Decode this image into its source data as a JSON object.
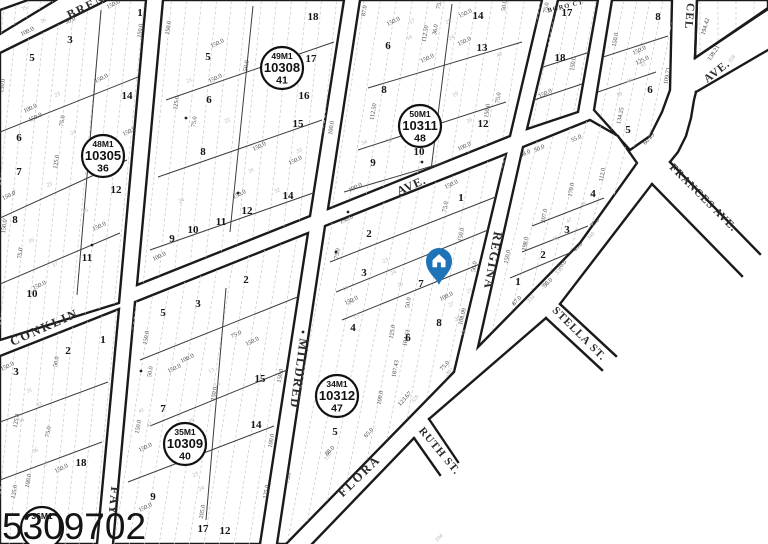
{
  "watermark": "5309702",
  "pin": {
    "color": "#1d72b8"
  },
  "streets": [
    {
      "name": "BREN",
      "x": 88,
      "y": 10,
      "rot": -26,
      "size": 12,
      "ls": 2,
      "faint": false
    },
    {
      "name": "CONKLIN",
      "x": 46,
      "y": 331,
      "rot": -24,
      "size": 12.5,
      "ls": 2,
      "faint": false
    },
    {
      "name": "AVE.",
      "x": 413,
      "y": 189,
      "rot": -24,
      "size": 12,
      "ls": 1,
      "faint": false
    },
    {
      "name": "FAY",
      "x": 110,
      "y": 501,
      "rot": 95,
      "size": 12.5,
      "ls": 2,
      "faint": false
    },
    {
      "name": "MILDRED",
      "x": 295,
      "y": 373,
      "rot": 98,
      "size": 12.5,
      "ls": 1.5,
      "faint": false
    },
    {
      "name": "REGINA",
      "x": 489,
      "y": 260,
      "rot": 100,
      "size": 12.5,
      "ls": 1.5,
      "faint": false
    },
    {
      "name": "FLORA",
      "x": 362,
      "y": 479,
      "rot": -44,
      "size": 12.5,
      "ls": 2,
      "faint": false
    },
    {
      "name": "RUTH ST.",
      "x": 437,
      "y": 453,
      "rot": 50,
      "size": 11,
      "ls": 1,
      "faint": false
    },
    {
      "name": "STELLA ST.",
      "x": 577,
      "y": 336,
      "rot": 45,
      "size": 11,
      "ls": 1,
      "faint": false
    },
    {
      "name": "FRANCES AVE.",
      "x": 701,
      "y": 200,
      "rot": 45,
      "size": 11,
      "ls": 1,
      "faint": false
    },
    {
      "name": "CEL",
      "x": 686,
      "y": 16,
      "rot": 95,
      "size": 11.5,
      "ls": 1,
      "faint": false
    },
    {
      "name": "AVE.",
      "x": 719,
      "y": 74,
      "rot": -38,
      "size": 11.5,
      "ls": 1,
      "faint": false
    },
    {
      "name": "BORO CT",
      "x": 566,
      "y": 8,
      "rot": -14,
      "size": 6.5,
      "ls": 1,
      "faint": true
    }
  ],
  "markers": [
    {
      "line1": "48M1",
      "line2": "10305",
      "line3": "36",
      "x": 103,
      "y": 156
    },
    {
      "line1": "49M1",
      "line2": "10308",
      "line3": "41",
      "x": 282,
      "y": 68
    },
    {
      "line1": "50M1",
      "line2": "10311",
      "line3": "48",
      "x": 420,
      "y": 126
    },
    {
      "line1": "34M1",
      "line2": "10312",
      "line3": "47",
      "x": 337,
      "y": 396
    },
    {
      "line1": "35M1",
      "line2": "10309",
      "line3": "40",
      "x": 185,
      "y": 444
    },
    {
      "line1": "36M1",
      "line2": "",
      "line3": "",
      "x": 42,
      "y": 528
    }
  ],
  "lots": [
    [
      "1",
      140,
      16
    ],
    [
      "3",
      70,
      43
    ],
    [
      "5",
      32,
      61
    ],
    [
      "14",
      127,
      99
    ],
    [
      "6",
      19,
      141
    ],
    [
      "7",
      19,
      175
    ],
    [
      "12",
      116,
      193
    ],
    [
      "8",
      15,
      223
    ],
    [
      "11",
      87,
      261
    ],
    [
      "10",
      32,
      297
    ],
    [
      "18",
      313,
      20
    ],
    [
      "17",
      311,
      62
    ],
    [
      "16",
      304,
      99
    ],
    [
      "15",
      298,
      127
    ],
    [
      "5",
      208,
      60
    ],
    [
      "6",
      209,
      103
    ],
    [
      "8",
      203,
      155
    ],
    [
      "14",
      288,
      199
    ],
    [
      "12",
      247,
      214
    ],
    [
      "11",
      221,
      225
    ],
    [
      "10",
      193,
      233
    ],
    [
      "9",
      172,
      242
    ],
    [
      "6",
      388,
      49
    ],
    [
      "8",
      384,
      93
    ],
    [
      "14",
      478,
      19
    ],
    [
      "13",
      482,
      51
    ],
    [
      "12",
      483,
      127
    ],
    [
      "10",
      419,
      155
    ],
    [
      "9",
      373,
      166
    ],
    [
      "17",
      567,
      16
    ],
    [
      "18",
      560,
      61
    ],
    [
      "8",
      658,
      20
    ],
    [
      "6",
      650,
      93
    ],
    [
      "5",
      628,
      133
    ],
    [
      "4",
      593,
      197
    ],
    [
      "3",
      567,
      233
    ],
    [
      "2",
      543,
      258
    ],
    [
      "1",
      518,
      285
    ],
    [
      "1",
      461,
      201
    ],
    [
      "2",
      369,
      237
    ],
    [
      "3",
      364,
      276
    ],
    [
      "7",
      421,
      287
    ],
    [
      "8",
      439,
      326
    ],
    [
      "6",
      408,
      341
    ],
    [
      "4",
      353,
      331
    ],
    [
      "5",
      335,
      435
    ],
    [
      "2",
      246,
      283
    ],
    [
      "3",
      198,
      307
    ],
    [
      "5",
      163,
      316
    ],
    [
      "15",
      260,
      382
    ],
    [
      "7",
      163,
      412
    ],
    [
      "14",
      256,
      428
    ],
    [
      "9",
      153,
      500
    ],
    [
      "17",
      203,
      532
    ],
    [
      "12",
      225,
      534
    ],
    [
      "1",
      103,
      343
    ],
    [
      "2",
      68,
      354
    ],
    [
      "3",
      16,
      375
    ],
    [
      "18",
      81,
      466
    ]
  ],
  "dims": [
    [
      "150.0",
      114,
      6,
      -26
    ],
    [
      "50.0",
      71,
      22,
      -26
    ],
    [
      "100.0",
      28,
      33,
      -26
    ],
    [
      "150.0",
      142,
      31,
      -82
    ],
    [
      "150.0",
      4,
      86,
      -82
    ],
    [
      "150.0",
      102,
      80,
      -26
    ],
    [
      "75.0",
      64,
      121,
      -82
    ],
    [
      "100.0",
      31,
      110,
      -26
    ],
    [
      "150.0",
      36,
      119,
      -26
    ],
    [
      "150.0",
      130,
      133,
      -26
    ],
    [
      "150.0'",
      10,
      197,
      -26
    ],
    [
      "75.0'",
      22,
      253,
      -82
    ],
    [
      "150.0'",
      6,
      226,
      -82
    ],
    [
      "150.0",
      100,
      228,
      -26
    ],
    [
      "125.0",
      58,
      162,
      -82
    ],
    [
      "150.0",
      40,
      287,
      -26
    ],
    [
      "150.0",
      170,
      28,
      -82
    ],
    [
      "150.0",
      218,
      45,
      -26
    ],
    [
      "50.0",
      248,
      66,
      -82
    ],
    [
      "125.0",
      178,
      103,
      -82
    ],
    [
      "150.0",
      216,
      80,
      -26
    ],
    [
      "150.0",
      260,
      148,
      -26
    ],
    [
      "75.0",
      196,
      122,
      -82
    ],
    [
      "150.0",
      240,
      196,
      -26
    ],
    [
      "100.0",
      160,
      258,
      -26
    ],
    [
      "150.0",
      296,
      162,
      -26
    ],
    [
      "100.0",
      333,
      128,
      -82
    ],
    [
      "87.0",
      366,
      11,
      -80
    ],
    [
      "150.0",
      394,
      23,
      -26
    ],
    [
      "112.50",
      427,
      34,
      -80
    ],
    [
      "36.0",
      437,
      30,
      -80
    ],
    [
      "150.0",
      466,
      15,
      -26
    ],
    [
      "150.0",
      465,
      43,
      -26
    ],
    [
      "50.0",
      506,
      6,
      -80
    ],
    [
      "75.0",
      441,
      4,
      -80
    ],
    [
      "112.50",
      375,
      112,
      -80
    ],
    [
      "150.0",
      428,
      60,
      -26
    ],
    [
      "75.0",
      500,
      98,
      -82
    ],
    [
      "150.0",
      489,
      111,
      -82
    ],
    [
      "100.0",
      465,
      148,
      -26
    ],
    [
      "150.0",
      430,
      142,
      -26
    ],
    [
      "75.0",
      548,
      8,
      -82
    ],
    [
      "150.0",
      575,
      64,
      -82
    ],
    [
      "150.0",
      546,
      95,
      -26
    ],
    [
      "150.0",
      617,
      40,
      -80
    ],
    [
      "150.0",
      640,
      52,
      -26
    ],
    [
      "125.0",
      643,
      62,
      -26
    ],
    [
      "109.71",
      669,
      76,
      -80
    ],
    [
      "134.25",
      622,
      116,
      -78
    ],
    [
      "60.29",
      650,
      140,
      -48
    ],
    [
      "55.0",
      577,
      140,
      -26
    ],
    [
      "98.0",
      526,
      155,
      -26
    ],
    [
      "50.0",
      540,
      150,
      -26
    ],
    [
      "112.0",
      604,
      175,
      -80
    ],
    [
      "170.0",
      573,
      190,
      -80
    ],
    [
      "207.0",
      546,
      216,
      -80
    ],
    [
      "198.0",
      527,
      244,
      -80
    ],
    [
      "150.0",
      509,
      257,
      -80
    ],
    [
      "75.0",
      596,
      224,
      -46
    ],
    [
      "45.0",
      579,
      248,
      -46
    ],
    [
      "70.0",
      563,
      266,
      -46
    ],
    [
      "50.0",
      549,
      284,
      -46
    ],
    [
      "87.0",
      518,
      302,
      -46
    ],
    [
      "100.0",
      356,
      189,
      -26
    ],
    [
      "150.0",
      452,
      186,
      -26
    ],
    [
      "75.0",
      447,
      207,
      -80
    ],
    [
      "150.0",
      347,
      221,
      -26
    ],
    [
      "75.0",
      339,
      254,
      -80
    ],
    [
      "150.0",
      463,
      235,
      -80
    ],
    [
      "50.0",
      476,
      267,
      -80
    ],
    [
      "50.0",
      410,
      303,
      -80
    ],
    [
      "100.0",
      447,
      298,
      -26
    ],
    [
      "108.09",
      464,
      317,
      -76
    ],
    [
      "104.61",
      408,
      338,
      -78
    ],
    [
      "125.0",
      394,
      332,
      -80
    ],
    [
      "187.43",
      397,
      369,
      -80
    ],
    [
      "100.0",
      382,
      398,
      -80
    ],
    [
      "123.67",
      406,
      400,
      -48
    ],
    [
      "88.0",
      331,
      452,
      -46
    ],
    [
      "65.0",
      370,
      434,
      -48
    ],
    [
      "75.0",
      446,
      367,
      -48
    ],
    [
      "150.0",
      352,
      302,
      -26
    ],
    [
      "150.0",
      148,
      338,
      -80
    ],
    [
      "75.0",
      237,
      336,
      -26
    ],
    [
      "150.0",
      253,
      343,
      -26
    ],
    [
      "100.0",
      188,
      360,
      -26
    ],
    [
      "150.0",
      175,
      370,
      -26
    ],
    [
      "50.0",
      152,
      372,
      -80
    ],
    [
      "150.0",
      282,
      376,
      -80
    ],
    [
      "150.0",
      216,
      394,
      -80
    ],
    [
      "150.0",
      140,
      427,
      -80
    ],
    [
      "150.0",
      146,
      449,
      -26
    ],
    [
      "100.0",
      273,
      441,
      -80
    ],
    [
      "75.0",
      290,
      478,
      -80
    ],
    [
      "125.0",
      268,
      492,
      -80
    ],
    [
      "205.0",
      204,
      512,
      -80
    ],
    [
      "150.0",
      146,
      509,
      -26
    ],
    [
      "150.0",
      8,
      368,
      -26
    ],
    [
      "50.0",
      58,
      362,
      -80
    ],
    [
      "125.0",
      18,
      421,
      -80
    ],
    [
      "75.0",
      50,
      432,
      -80
    ],
    [
      "150.0",
      62,
      470,
      -26
    ],
    [
      "100.0",
      30,
      481,
      -80
    ],
    [
      "125.0",
      16,
      492,
      -80
    ],
    [
      "194.42",
      707,
      27,
      -74
    ],
    [
      "138.21",
      715,
      54,
      -56
    ]
  ],
  "faint": [
    [
      "75",
      25,
      10,
      -26
    ],
    [
      "36",
      44,
      22,
      -26
    ],
    [
      "23",
      58,
      96,
      -26
    ],
    [
      "24",
      74,
      134,
      -26
    ],
    [
      "25",
      50,
      186,
      -26
    ],
    [
      "26",
      86,
      212,
      -26
    ],
    [
      "16",
      32,
      242,
      -26
    ],
    [
      "17",
      56,
      266,
      -26
    ],
    [
      "21",
      190,
      82,
      -26
    ],
    [
      "22",
      228,
      122,
      -26
    ],
    [
      "31",
      252,
      172,
      -26
    ],
    [
      "32",
      278,
      192,
      -26
    ],
    [
      "33",
      300,
      152,
      -26
    ],
    [
      "24",
      182,
      202,
      -26
    ],
    [
      "34",
      365,
      144,
      -26
    ],
    [
      "35",
      390,
      142,
      -26
    ],
    [
      "17",
      413,
      23,
      -26
    ],
    [
      "16",
      410,
      39,
      -26
    ],
    [
      "25",
      449,
      23,
      -26
    ],
    [
      "24",
      452,
      39,
      -26
    ],
    [
      "19",
      456,
      96,
      -26
    ],
    [
      "20",
      470,
      122,
      -26
    ],
    [
      "43",
      500,
      56,
      -26
    ],
    [
      "40",
      630,
      82,
      -26
    ],
    [
      "41",
      644,
      66,
      -26
    ],
    [
      "39",
      620,
      96,
      -26
    ],
    [
      "46",
      556,
      240,
      -26
    ],
    [
      "47",
      570,
      222,
      -26
    ],
    [
      "48",
      584,
      206,
      -26
    ],
    [
      "334",
      532,
      300,
      -46
    ],
    [
      "336",
      546,
      286,
      -46
    ],
    [
      "338",
      560,
      272,
      -46
    ],
    [
      "340",
      592,
      237,
      -46
    ],
    [
      "13",
      346,
      290,
      -26
    ],
    [
      "14",
      352,
      304,
      -26
    ],
    [
      "15",
      357,
      318,
      -26
    ],
    [
      "23",
      386,
      262,
      -26
    ],
    [
      "24",
      394,
      274,
      -26
    ],
    [
      "25",
      401,
      286,
      -26
    ],
    [
      "21",
      470,
      292,
      -26
    ],
    [
      "27",
      452,
      306,
      -26
    ],
    [
      "28",
      458,
      320,
      -26
    ],
    [
      "29",
      464,
      334,
      -26
    ],
    [
      "310",
      329,
      458,
      -46
    ],
    [
      "302",
      451,
      373,
      -46
    ],
    [
      "320",
      416,
      400,
      -48
    ],
    [
      "104",
      440,
      539,
      -44
    ],
    [
      "13",
      212,
      372,
      -26
    ],
    [
      "14",
      218,
      386,
      -26
    ],
    [
      "16",
      192,
      422,
      -26
    ],
    [
      "20",
      172,
      452,
      -26
    ],
    [
      "23",
      196,
      476,
      -26
    ],
    [
      "24",
      202,
      490,
      -26
    ],
    [
      "41",
      142,
      412,
      -26
    ],
    [
      "42",
      150,
      426,
      -26
    ],
    [
      "31",
      30,
      392,
      -26
    ],
    [
      "33",
      40,
      406,
      -26
    ],
    [
      "34",
      22,
      422,
      -26
    ],
    [
      "36",
      36,
      452,
      -26
    ],
    [
      "37",
      46,
      466,
      -26
    ],
    [
      "358",
      733,
      60,
      -52
    ]
  ],
  "dots": [
    [
      348,
      212
    ],
    [
      336,
      252
    ],
    [
      186,
      118
    ],
    [
      238,
      193
    ],
    [
      141,
      371
    ],
    [
      92,
      245
    ],
    [
      422,
      162
    ],
    [
      303,
      332
    ]
  ],
  "geometry": {
    "blocks": [
      {
        "pts": "0,53 107,0 146,0 119,303 0,340",
        "slope": 0.1,
        "gap": 14,
        "med": [
          [
            0,
            132,
            138,
            77
          ],
          [
            0,
            218,
            127,
            160
          ],
          [
            0,
            284,
            120,
            233
          ],
          [
            101,
            10,
            77,
            295
          ]
        ]
      },
      {
        "pts": "163,0 344,0 310,216 137,285",
        "slope": 0.1,
        "gap": 15,
        "med": [
          [
            150,
            250,
            316,
            192
          ],
          [
            158,
            177,
            322,
            120
          ],
          [
            166,
            100,
            334,
            42
          ],
          [
            253,
            6,
            230,
            232
          ]
        ]
      },
      {
        "pts": "360,0 542,0 510,136 328,209",
        "slope": 0.155,
        "gap": 16,
        "med": [
          [
            368,
            88,
            522,
            42
          ],
          [
            358,
            150,
            506,
            102
          ],
          [
            344,
            192,
            500,
            146
          ],
          [
            452,
            4,
            431,
            170
          ]
        ]
      },
      {
        "pts": "558,0 598,0 578,112 527,129",
        "slope": 0.2,
        "gap": 13,
        "med": [
          [
            540,
            68,
            590,
            52
          ],
          [
            534,
            100,
            582,
            84
          ]
        ]
      },
      {
        "pts": "612,0 672,0 670,90 662,112 650,136 630,150 594,110",
        "slope": 0.2,
        "gap": 13,
        "med": [
          [
            600,
            58,
            668,
            36
          ],
          [
            598,
            92,
            656,
            72
          ]
        ]
      },
      {
        "pts": "523,147 590,120 618,136 637,163 580,243 478,347",
        "slope": 0.237,
        "gap": 15,
        "med": [
          [
            532,
            226,
            604,
            198
          ],
          [
            522,
            252,
            588,
            226
          ],
          [
            510,
            278,
            572,
            252
          ]
        ]
      },
      {
        "pts": "325,226 506,154 454,372 286,544 277,544",
        "slope": 0.19,
        "gap": 16,
        "med": [
          [
            330,
            262,
            498,
            196
          ],
          [
            336,
            292,
            488,
            230
          ],
          [
            342,
            320,
            480,
            264
          ]
        ]
      },
      {
        "pts": "135,302 308,233 260,544 113,544",
        "slope": 0.155,
        "gap": 15,
        "med": [
          [
            140,
            360,
            300,
            296
          ],
          [
            150,
            426,
            292,
            368
          ],
          [
            128,
            482,
            274,
            426
          ],
          [
            226,
            288,
            206,
            520
          ]
        ]
      },
      {
        "pts": "0,356 119,309 97,544 0,544",
        "slope": 0.1,
        "gap": 14,
        "med": [
          [
            0,
            422,
            108,
            382
          ],
          [
            0,
            480,
            102,
            442
          ]
        ]
      },
      {
        "pts": "0,34 0,10 28,0 56,0",
        "slope": 0.1,
        "gap": 12,
        "med": []
      },
      {
        "pts": "697,0 768,0 768,9 695,58",
        "slope": 0.0,
        "gap": 18,
        "med": []
      }
    ],
    "edges": [
      "312,544 414,438",
      "429,419 546,318",
      "414,438 440,475",
      "429,419 458,462",
      "546,318 602,370",
      "560,304 616,356",
      "560,304 652,184",
      "652,184 742,276",
      "670,162 760,254",
      "670,162 678,152 686,136 691,118 694,100 696,92",
      "697,0 695,58",
      "695,58 768,8",
      "696,92 768,50"
    ]
  }
}
